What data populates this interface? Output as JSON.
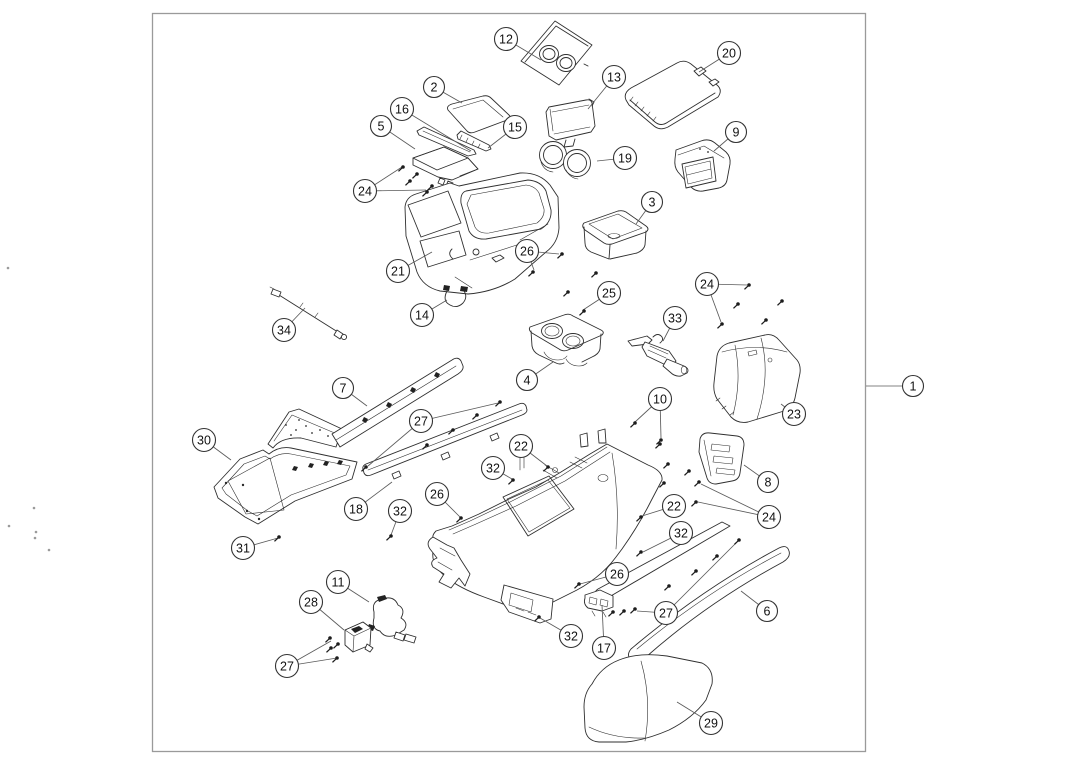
{
  "figure": {
    "type": "exploded-parts-diagram",
    "description": "Center console assembly exploded view with numbered callouts",
    "colors": {
      "background": "#ffffff",
      "frame": "#9a9a9a",
      "line": "#2f2f2f",
      "leader": "#5a5a5a",
      "balloon_stroke": "#333333",
      "balloon_fill": "#ffffff",
      "balloon_text": "#111111",
      "screw": "#1c1c1c",
      "artifact": "#888888"
    },
    "frame_rect": {
      "x": 152.5,
      "y": 13.5,
      "width": 713,
      "height": 738
    }
  },
  "callouts": [
    {
      "label": "12",
      "x": 506,
      "y": 39,
      "leaders": [
        [
          541,
          60
        ]
      ]
    },
    {
      "label": "2",
      "x": 434,
      "y": 87,
      "leaders": [
        [
          462,
          103
        ]
      ]
    },
    {
      "label": "13",
      "x": 614,
      "y": 77,
      "leaders": [
        [
          588,
          109
        ]
      ]
    },
    {
      "label": "20",
      "x": 729,
      "y": 53,
      "leaders": [
        [
          699,
          72
        ]
      ]
    },
    {
      "label": "16",
      "x": 402,
      "y": 109,
      "leaders": [
        [
          471,
          151
        ]
      ]
    },
    {
      "label": "5",
      "x": 381,
      "y": 126,
      "leaders": [
        [
          415,
          149
        ]
      ]
    },
    {
      "label": "15",
      "x": 515,
      "y": 127,
      "leaders": [
        [
          488,
          148
        ]
      ]
    },
    {
      "label": "9",
      "x": 736,
      "y": 132,
      "leaders": [
        [
          714,
          151
        ]
      ]
    },
    {
      "label": "19",
      "x": 625,
      "y": 158,
      "leaders": [
        [
          597,
          161
        ]
      ]
    },
    {
      "label": "24",
      "x": 365,
      "y": 191,
      "leaders": [
        [
          402,
          167
        ],
        [
          426,
          190
        ]
      ]
    },
    {
      "label": "3",
      "x": 652,
      "y": 202,
      "leaders": [
        [
          636,
          224
        ]
      ]
    },
    {
      "label": "26",
      "x": 527,
      "y": 251,
      "leaders": [
        [
          559,
          254
        ],
        [
          534,
          270
        ]
      ]
    },
    {
      "label": "21",
      "x": 398,
      "y": 271,
      "leaders": [
        [
          432,
          252
        ]
      ]
    },
    {
      "label": "14",
      "x": 422,
      "y": 315,
      "leaders": [
        [
          447,
          300
        ]
      ]
    },
    {
      "label": "25",
      "x": 609,
      "y": 293,
      "leaders": [
        [
          583,
          310
        ]
      ]
    },
    {
      "label": "33",
      "x": 675,
      "y": 318,
      "leaders": [
        [
          663,
          341
        ]
      ]
    },
    {
      "label": "24",
      "x": 707,
      "y": 284,
      "leaders": [
        [
          747,
          285
        ],
        [
          721,
          322
        ]
      ]
    },
    {
      "label": "34",
      "x": 284,
      "y": 330,
      "leaders": [
        [
          305,
          308
        ]
      ]
    },
    {
      "label": "7",
      "x": 343,
      "y": 388,
      "leaders": [
        [
          367,
          406
        ]
      ]
    },
    {
      "label": "4",
      "x": 527,
      "y": 380,
      "leaders": [
        [
          553,
          362
        ]
      ]
    },
    {
      "label": "10",
      "x": 660,
      "y": 399,
      "leaders": [
        [
          635,
          422
        ],
        [
          661,
          438
        ]
      ]
    },
    {
      "label": "23",
      "x": 794,
      "y": 414,
      "leaders": [
        [
          781,
          404
        ]
      ]
    },
    {
      "label": "27",
      "x": 421,
      "y": 421,
      "leaders": [
        [
          498,
          403
        ],
        [
          368,
          466
        ]
      ]
    },
    {
      "label": "30",
      "x": 204,
      "y": 440,
      "leaders": [
        [
          231,
          460
        ]
      ]
    },
    {
      "label": "22",
      "x": 521,
      "y": 446,
      "leaders": [
        [
          547,
          466
        ]
      ]
    },
    {
      "label": "32",
      "x": 493,
      "y": 468,
      "leaders": [
        [
          512,
          479
        ]
      ]
    },
    {
      "label": "8",
      "x": 768,
      "y": 482,
      "leaders": [
        [
          744,
          465
        ]
      ]
    },
    {
      "label": "26",
      "x": 437,
      "y": 494,
      "leaders": [
        [
          460,
          517
        ]
      ]
    },
    {
      "label": "22",
      "x": 674,
      "y": 506,
      "leaders": [
        [
          642,
          516
        ]
      ]
    },
    {
      "label": "18",
      "x": 356,
      "y": 509,
      "leaders": [
        [
          392,
          482
        ]
      ]
    },
    {
      "label": "32",
      "x": 400,
      "y": 511,
      "leaders": [
        [
          391,
          535
        ]
      ]
    },
    {
      "label": "24",
      "x": 769,
      "y": 517,
      "leaders": [
        [
          701,
          484
        ],
        [
          698,
          502
        ]
      ]
    },
    {
      "label": "32",
      "x": 681,
      "y": 533,
      "leaders": [
        [
          643,
          552
        ]
      ]
    },
    {
      "label": "31",
      "x": 243,
      "y": 548,
      "leaders": [
        [
          278,
          538
        ]
      ]
    },
    {
      "label": "26",
      "x": 617,
      "y": 574,
      "leaders": [
        [
          580,
          584
        ]
      ]
    },
    {
      "label": "11",
      "x": 338,
      "y": 582,
      "leaders": [
        [
          369,
          602
        ]
      ]
    },
    {
      "label": "28",
      "x": 311,
      "y": 602,
      "leaders": [
        [
          344,
          630
        ]
      ]
    },
    {
      "label": "27",
      "x": 666,
      "y": 613,
      "leaders": [
        [
          637,
          611
        ],
        [
          738,
          541
        ]
      ]
    },
    {
      "label": "6",
      "x": 767,
      "y": 611,
      "leaders": [
        [
          741,
          591
        ]
      ]
    },
    {
      "label": "32",
      "x": 571,
      "y": 636,
      "leaders": [
        [
          540,
          618
        ]
      ]
    },
    {
      "label": "17",
      "x": 604,
      "y": 648,
      "leaders": [
        [
          602,
          605
        ]
      ]
    },
    {
      "label": "27",
      "x": 287,
      "y": 666,
      "leaders": [
        [
          331,
          641
        ],
        [
          337,
          658
        ]
      ]
    },
    {
      "label": "29",
      "x": 711,
      "y": 723,
      "leaders": [
        [
          677,
          702
        ]
      ]
    },
    {
      "label": "1",
      "x": 913,
      "y": 386,
      "leaders": [
        [
          866,
          386
        ]
      ]
    }
  ],
  "screws": [
    [
      403,
      167
    ],
    [
      417,
      174
    ],
    [
      410,
      181
    ],
    [
      432,
      186
    ],
    [
      427,
      192
    ],
    [
      562,
      254
    ],
    [
      533,
      272
    ],
    [
      596,
      273
    ],
    [
      568,
      292
    ],
    [
      584,
      311
    ],
    [
      749,
      285
    ],
    [
      738,
      304
    ],
    [
      782,
      301
    ],
    [
      766,
      320
    ],
    [
      722,
      324
    ],
    [
      635,
      423
    ],
    [
      661,
      440
    ],
    [
      660,
      444
    ],
    [
      668,
      464
    ],
    [
      689,
      471
    ],
    [
      664,
      483
    ],
    [
      699,
      482
    ],
    [
      696,
      502
    ],
    [
      427,
      445
    ],
    [
      453,
      430
    ],
    [
      477,
      415
    ],
    [
      500,
      402
    ],
    [
      366,
      467
    ],
    [
      548,
      467
    ],
    [
      513,
      480
    ],
    [
      461,
      518
    ],
    [
      641,
      517
    ],
    [
      391,
      536
    ],
    [
      279,
      537
    ],
    [
      641,
      552
    ],
    [
      579,
      584
    ],
    [
      539,
      617
    ],
    [
      330,
      638
    ],
    [
      338,
      644
    ],
    [
      331,
      648
    ],
    [
      337,
      658
    ],
    [
      613,
      612
    ],
    [
      624,
      611
    ],
    [
      635,
      609
    ],
    [
      669,
      586
    ],
    [
      696,
      571
    ],
    [
      717,
      556
    ],
    [
      739,
      540
    ]
  ],
  "artifacts": [
    [
      9,
      526
    ],
    [
      34,
      508
    ],
    [
      36,
      532
    ],
    [
      35,
      538
    ],
    [
      49,
      550
    ],
    [
      8,
      268
    ]
  ]
}
